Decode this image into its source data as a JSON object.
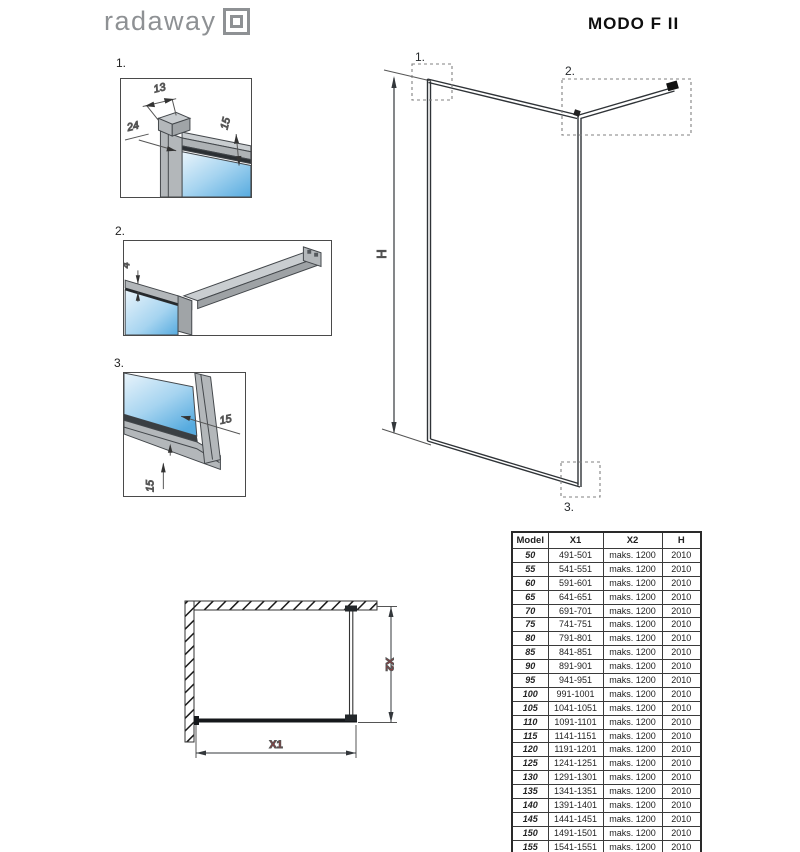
{
  "header": {
    "brand": "radaway",
    "product": "MODO F II"
  },
  "details": {
    "d1": {
      "label": "1.",
      "dim_top": "13",
      "dim_left": "24",
      "dim_right": "15"
    },
    "d2": {
      "label": "2.",
      "dim_left": "4"
    },
    "d3": {
      "label": "3.",
      "dim_right": "15",
      "dim_bottom": "15"
    }
  },
  "elevation": {
    "height_label": "H",
    "callout_1": "1.",
    "callout_2": "2.",
    "callout_3": "3."
  },
  "plan": {
    "width_label": "X1",
    "depth_label": "X2"
  },
  "table": {
    "headers": {
      "model": "Model",
      "x1": "X1",
      "x2": "X2",
      "h": "H"
    },
    "rows": [
      {
        "model": "50",
        "x1": "491-501",
        "x2": "maks. 1200",
        "h": "2010"
      },
      {
        "model": "55",
        "x1": "541-551",
        "x2": "maks. 1200",
        "h": "2010"
      },
      {
        "model": "60",
        "x1": "591-601",
        "x2": "maks. 1200",
        "h": "2010"
      },
      {
        "model": "65",
        "x1": "641-651",
        "x2": "maks. 1200",
        "h": "2010"
      },
      {
        "model": "70",
        "x1": "691-701",
        "x2": "maks. 1200",
        "h": "2010"
      },
      {
        "model": "75",
        "x1": "741-751",
        "x2": "maks. 1200",
        "h": "2010"
      },
      {
        "model": "80",
        "x1": "791-801",
        "x2": "maks. 1200",
        "h": "2010"
      },
      {
        "model": "85",
        "x1": "841-851",
        "x2": "maks. 1200",
        "h": "2010"
      },
      {
        "model": "90",
        "x1": "891-901",
        "x2": "maks. 1200",
        "h": "2010"
      },
      {
        "model": "95",
        "x1": "941-951",
        "x2": "maks. 1200",
        "h": "2010"
      },
      {
        "model": "100",
        "x1": "991-1001",
        "x2": "maks. 1200",
        "h": "2010"
      },
      {
        "model": "105",
        "x1": "1041-1051",
        "x2": "maks. 1200",
        "h": "2010"
      },
      {
        "model": "110",
        "x1": "1091-1101",
        "x2": "maks. 1200",
        "h": "2010"
      },
      {
        "model": "115",
        "x1": "1141-1151",
        "x2": "maks. 1200",
        "h": "2010"
      },
      {
        "model": "120",
        "x1": "1191-1201",
        "x2": "maks. 1200",
        "h": "2010"
      },
      {
        "model": "125",
        "x1": "1241-1251",
        "x2": "maks. 1200",
        "h": "2010"
      },
      {
        "model": "130",
        "x1": "1291-1301",
        "x2": "maks. 1200",
        "h": "2010"
      },
      {
        "model": "135",
        "x1": "1341-1351",
        "x2": "maks. 1200",
        "h": "2010"
      },
      {
        "model": "140",
        "x1": "1391-1401",
        "x2": "maks. 1200",
        "h": "2010"
      },
      {
        "model": "145",
        "x1": "1441-1451",
        "x2": "maks. 1200",
        "h": "2010"
      },
      {
        "model": "150",
        "x1": "1491-1501",
        "x2": "maks. 1200",
        "h": "2010"
      },
      {
        "model": "155",
        "x1": "1541-1551",
        "x2": "maks. 1200",
        "h": "2010"
      },
      {
        "model": "160",
        "x1": "1591-1601",
        "x2": "maks. 1200",
        "h": "2010"
      }
    ]
  },
  "colors": {
    "accent_red": "#c1272d",
    "glass_blue": "#57abdf",
    "profile_gray": "#b3b7ba",
    "logo_gray": "#8e9194",
    "line_dark": "#33373b"
  }
}
